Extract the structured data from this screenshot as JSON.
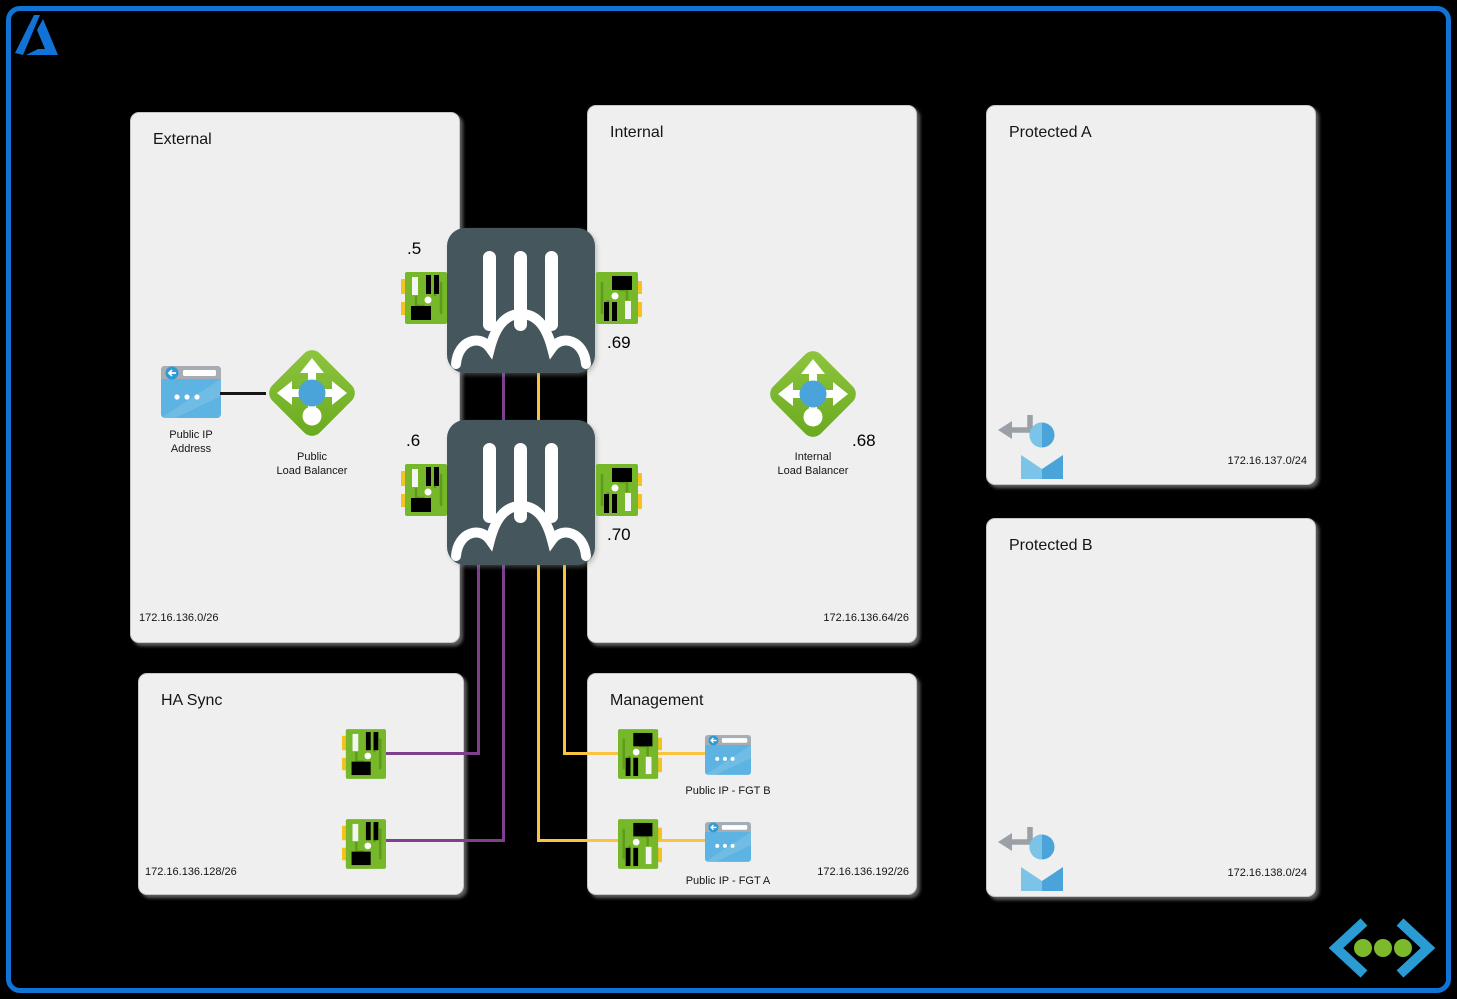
{
  "zones": {
    "external": {
      "title": "External",
      "cidr": "172.16.136.0/26"
    },
    "internal": {
      "title": "Internal",
      "cidr": "172.16.136.64/26"
    },
    "protected_a": {
      "title": "Protected A",
      "cidr": "172.16.137.0/24"
    },
    "protected_b": {
      "title": "Protected B",
      "cidr": "172.16.138.0/24"
    },
    "ha_sync": {
      "title": "HA Sync",
      "cidr": "172.16.136.128/26"
    },
    "management": {
      "title": "Management",
      "cidr": "172.16.136.192/26"
    }
  },
  "nodes": {
    "public_ip": {
      "line1": "Public IP",
      "line2": "Address"
    },
    "public_lb": {
      "line1": "Public",
      "line2": "Load Balancer"
    },
    "internal_lb": {
      "line1": "Internal",
      "line2": "Load Balancer",
      "ip": ".68"
    },
    "fgt_a": {
      "port_external": ".5",
      "port_internal": ".69"
    },
    "fgt_b": {
      "port_external": ".6",
      "port_internal": ".70"
    },
    "pip_fgt_b": {
      "label": "Public IP - FGT B"
    },
    "pip_fgt_a": {
      "label": "Public IP - FGT A"
    }
  },
  "icons": {
    "azure_logo": "azure-a-logo",
    "firewall": "fortigate-firewall",
    "nic": "network-interface-card",
    "load_balancer": "load-balancer-diamond",
    "public_ip": "browser-window",
    "subnet_user": "return-arrow-person",
    "code_logo": "chevrons-with-dots"
  },
  "colors": {
    "frame_blue": "#1173d6",
    "box_bg": "#efefef",
    "line_purple": "#7e3f8f",
    "line_yellow": "#f9c440",
    "fgt_slate": "#45565c",
    "nic_green": "#76b82a",
    "nic_yellow": "#f3c321",
    "lb_green": "#79b829",
    "lb_center_blue": "#4aa4d9",
    "icon_blue": "#5db3e2",
    "logo_chevron_blue": "#2b9bd4",
    "logo_dot_green": "#7cba2b"
  }
}
